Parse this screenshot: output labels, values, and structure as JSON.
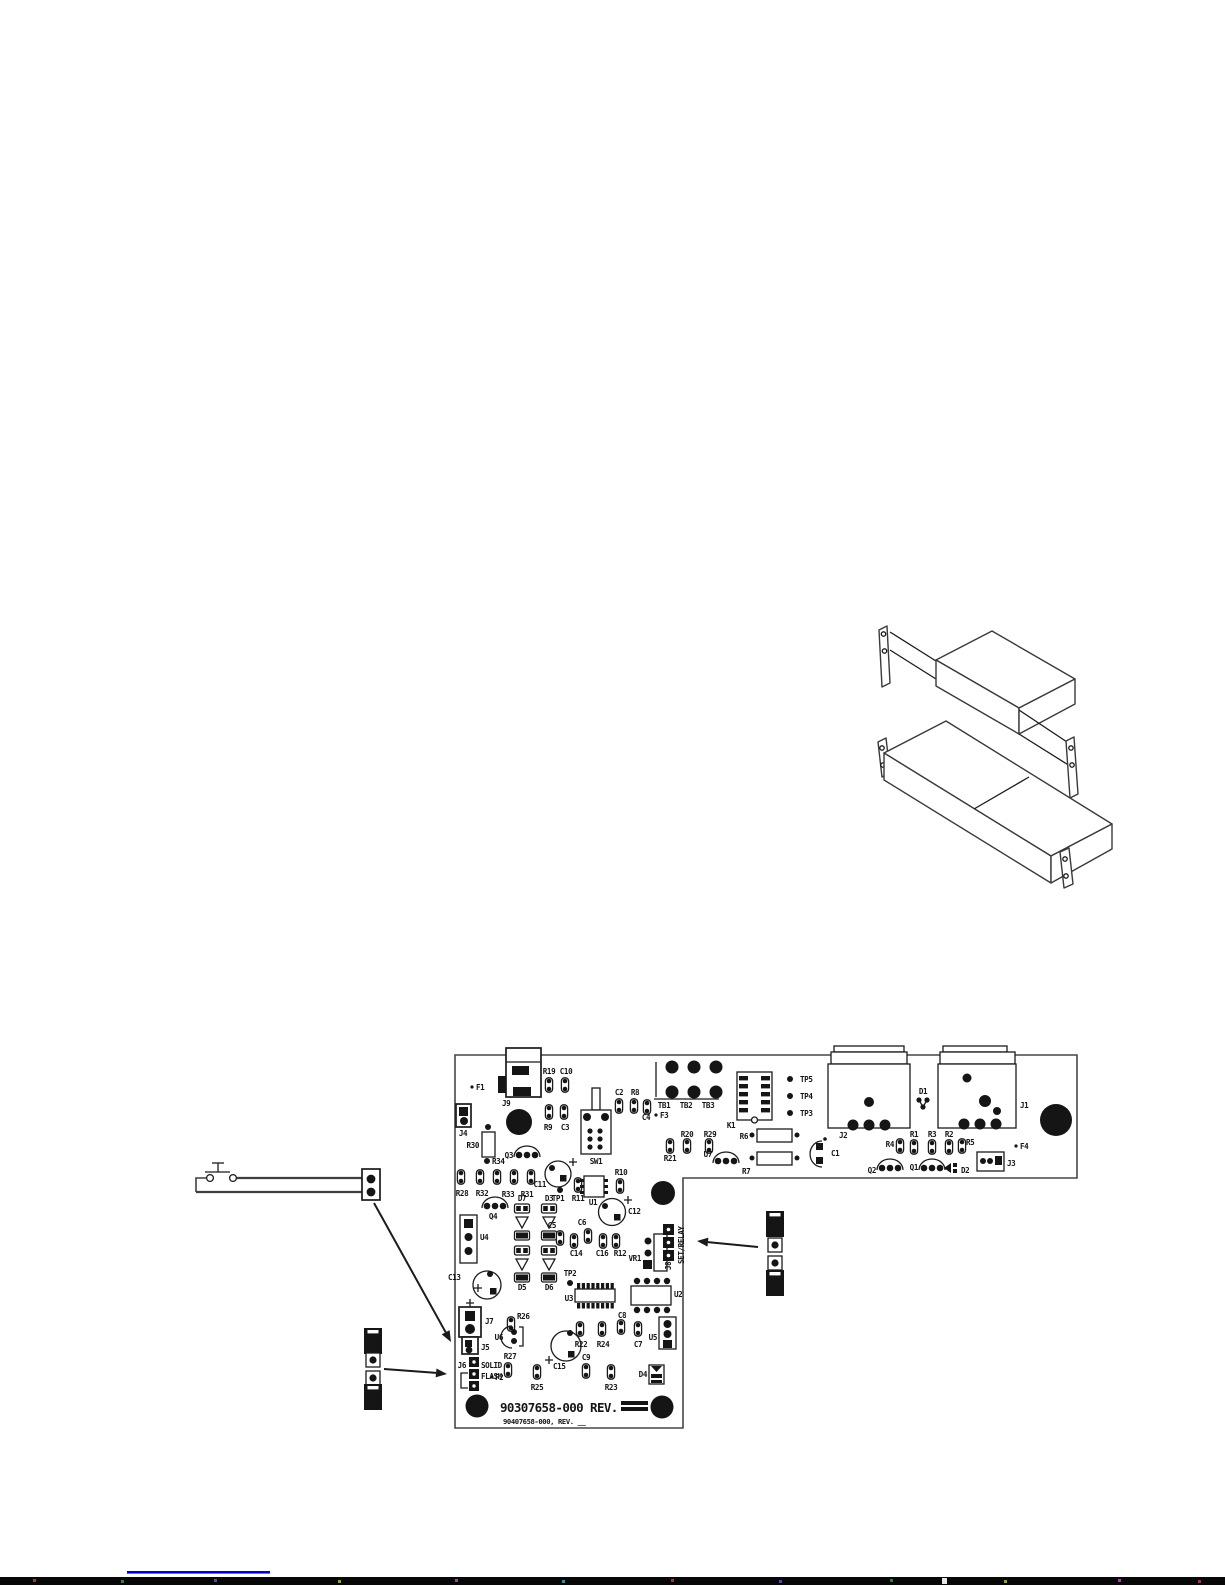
{
  "pcb": {
    "board_number": "90307658-000 REV.",
    "board_number_alt": "90407658-000, REV. __",
    "silkscreen": {
      "f1": "F1",
      "j9": "J9",
      "j4": "J4",
      "r30": "R30",
      "r34": "R34",
      "q3": "Q3",
      "r19": "R19",
      "c10": "C10",
      "r9": "R9",
      "c3": "C3",
      "sw1": "SW1",
      "c2": "C2",
      "r8": "R8",
      "c4": "C4",
      "tb1": "TB1",
      "tb2": "TB2",
      "tb3": "TB3",
      "f3": "F3",
      "r20": "R20",
      "r29": "R29",
      "r21": "R21",
      "k1": "K1",
      "tp5": "TP5",
      "tp4": "TP4",
      "tp3": "TP3",
      "r6": "R6",
      "u7": "U7",
      "r7": "R7",
      "c1": "C1",
      "j2": "J2",
      "d1": "D1",
      "j1": "J1",
      "r4": "R4",
      "r1": "R1",
      "r3": "R3",
      "r2": "R2",
      "r5": "R5",
      "q2": "Q2",
      "q1": "Q1",
      "d2": "D2",
      "j3": "J3",
      "f4": "F4",
      "r28": "R28",
      "r32": "R32",
      "r33": "R33",
      "r31": "R31",
      "q4": "Q4",
      "c11": "C11",
      "tp1": "TP1",
      "r11": "R11",
      "u1": "U1",
      "r10": "R10",
      "c12": "C12",
      "d7": "D7",
      "d3": "D3",
      "u4": "U4",
      "c5": "C5",
      "c6": "C6",
      "c14": "C14",
      "c16": "C16",
      "r12": "R12",
      "vr1": "VR1",
      "j8": "J8",
      "set_relay": "SET/RELAY",
      "d5": "D5",
      "d6": "D6",
      "c13": "C13",
      "tp2": "TP2",
      "u3": "U3",
      "u2": "U2",
      "j7": "J7",
      "r26": "R26",
      "u6": "U6",
      "c15": "C15",
      "r22": "R22",
      "r24": "R24",
      "c8": "C8",
      "c7": "C7",
      "u5": "U5",
      "j5": "J5",
      "j6": "J6",
      "solid": "SOLID",
      "flash": "FLASH",
      "f2": "F2",
      "r27": "R27",
      "r25": "R25",
      "c9": "C9",
      "r23": "R23",
      "d4": "D4"
    }
  },
  "colors": {
    "silkscreen_ink": "#151515",
    "board_outline": "#474747",
    "footer_link": "#0000cd",
    "scan_strip": "#070707"
  }
}
